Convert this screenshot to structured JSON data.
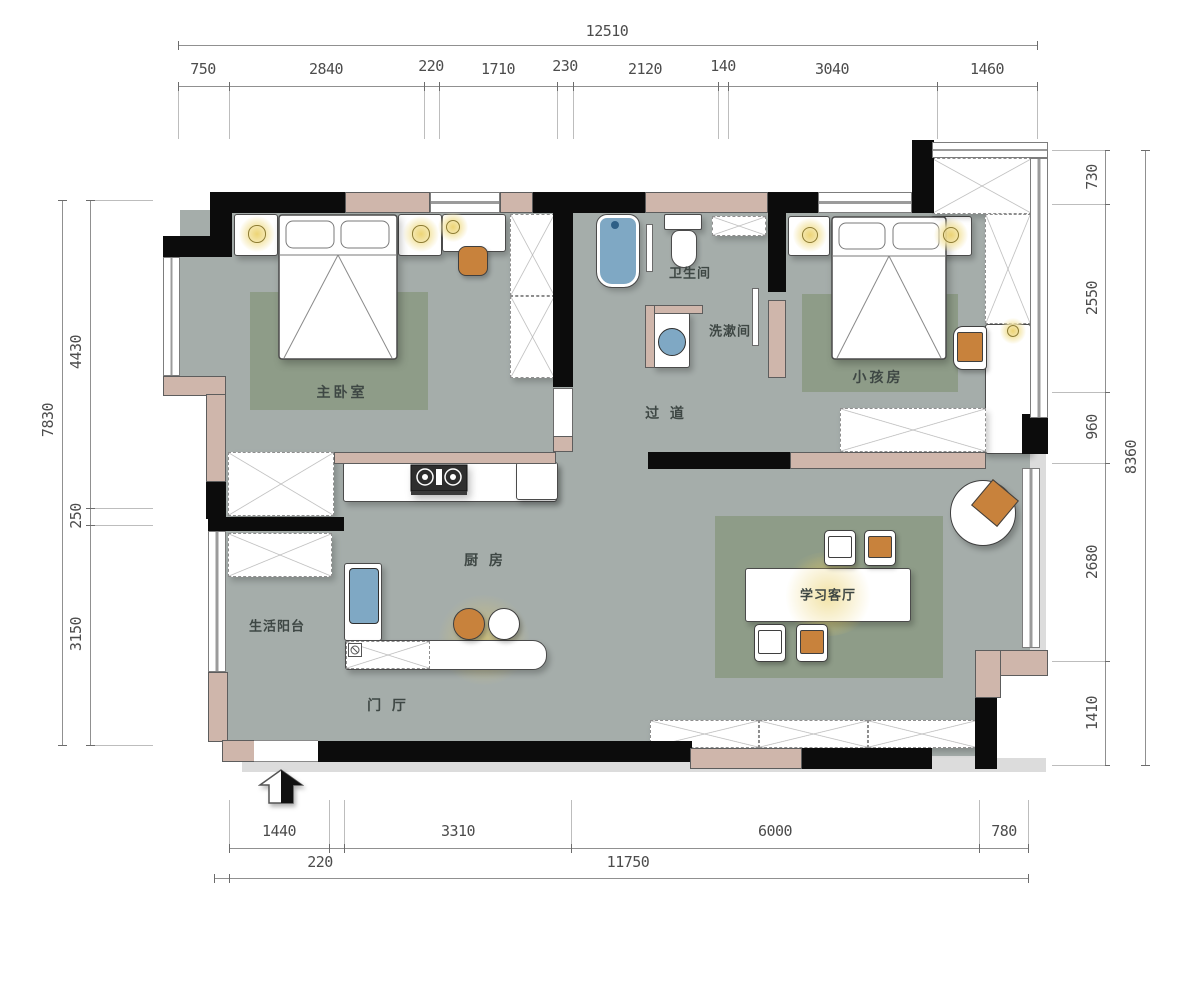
{
  "plan_title": "apartment-floor-plan",
  "rooms": {
    "master_bedroom": "主卧室",
    "bathroom": "卫生间",
    "washroom": "洗漱间",
    "corridor": "过 道",
    "kids_room": "小孩房",
    "kitchen": "厨 房",
    "living_balcony": "生活阳台",
    "entry_hall": "门 厅",
    "study_living": "学习客厅"
  },
  "dimensions": {
    "top": {
      "total": "12510",
      "segments": [
        "750",
        "2840",
        "220",
        "1710",
        "230",
        "2120",
        "140",
        "3040",
        "1460"
      ]
    },
    "left": {
      "total": "7830",
      "segments": [
        "4430",
        "250",
        "3150"
      ]
    },
    "right": {
      "total": "8360",
      "segments": [
        "730",
        "2550",
        "960",
        "2680",
        "1410"
      ]
    },
    "bottom": {
      "row1": [
        "1440",
        "3310",
        "6000",
        "780"
      ],
      "row2": [
        "220",
        "11750"
      ]
    }
  },
  "colors": {
    "floor": "#a5adaa",
    "rug": "#8e9c88",
    "wall_black": "#0c0c0c",
    "wall_pink": "#cfb6ab",
    "accent_orange": "#c8823c",
    "fixture_blue": "#7fa8c4",
    "lamp_yellow": "#ecd26e"
  },
  "icons": {
    "entrance_arrow": "entry-direction-arrow",
    "lamp": "ceiling-lamp-glow",
    "washer": "washing-machine"
  }
}
